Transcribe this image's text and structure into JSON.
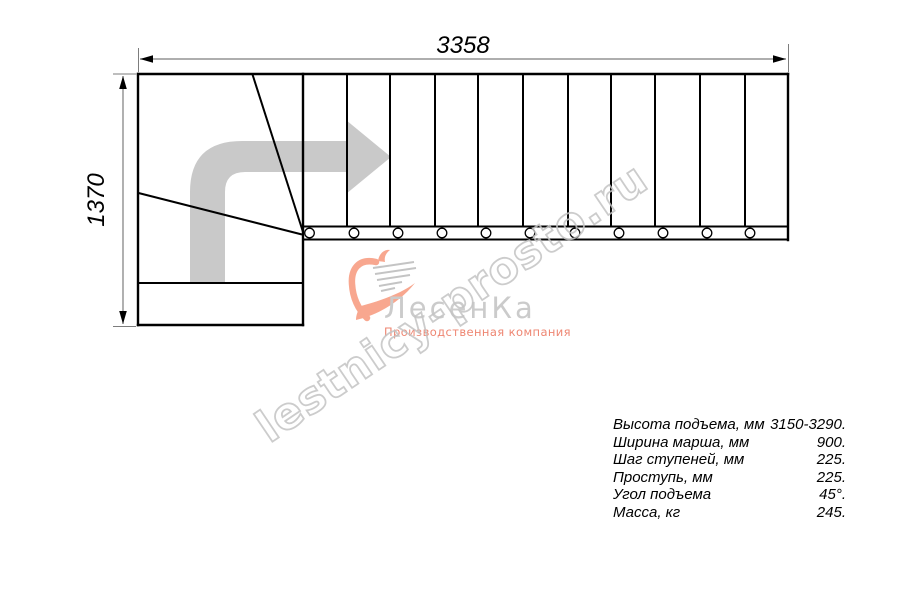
{
  "drawing": {
    "dimensions": {
      "width_label": "3358",
      "height_label": "1370"
    },
    "colors": {
      "line": "#000000",
      "dimension_line": "#7d7d7d",
      "direction_arrow": "#c9c9c9"
    }
  },
  "logo": {
    "brand": "ЛесенКа",
    "tagline": "Производственная компания",
    "brand_color": "#cbcbcb",
    "tagline_color": "#ee8672",
    "heart_color": "#f8a78f"
  },
  "watermark": {
    "text": "lestnicy-prosto.ru",
    "color": "#c4c4c4"
  },
  "specs": {
    "rows": [
      {
        "label": "Высота подъема, мм",
        "value": "3150-3290."
      },
      {
        "label": "Ширина марша, мм",
        "value": "900."
      },
      {
        "label": "Шаг ступеней, мм",
        "value": "225."
      },
      {
        "label": "Проступь, мм",
        "value": "225."
      },
      {
        "label": "Угол подъема",
        "value": "45°."
      },
      {
        "label": "Масса, кг",
        "value": "245."
      }
    ]
  }
}
